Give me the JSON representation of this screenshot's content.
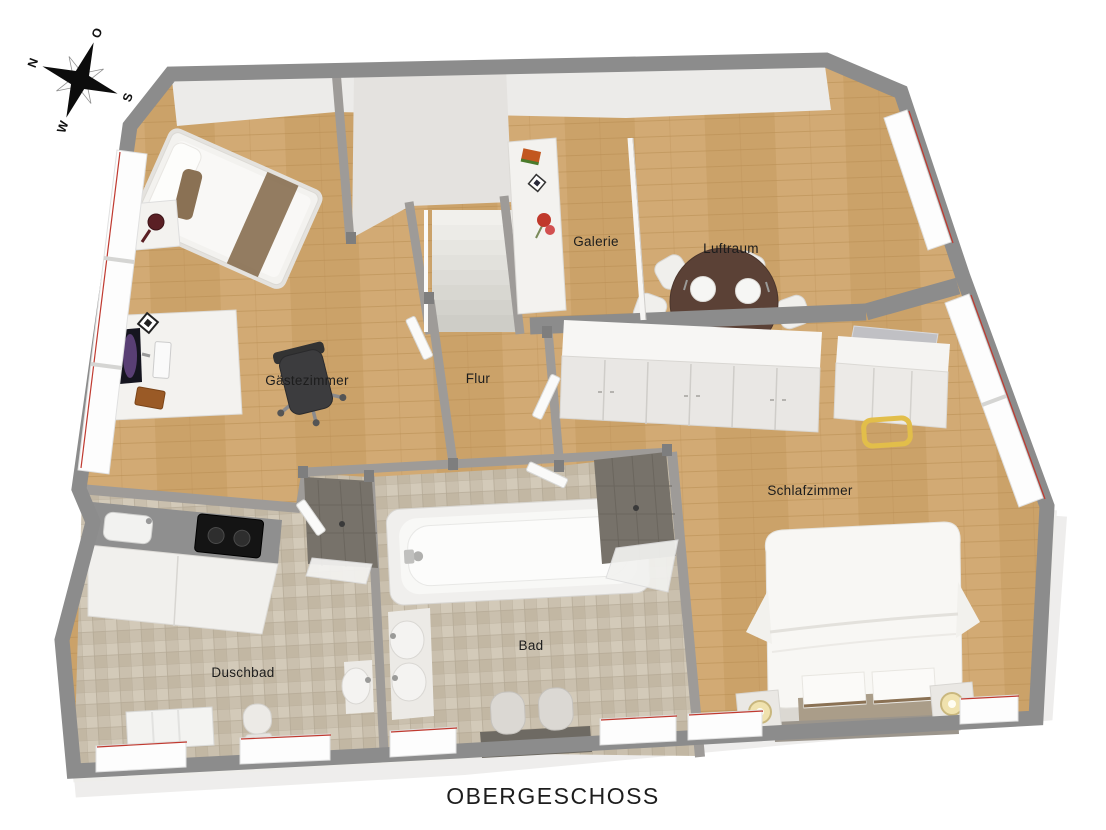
{
  "title": "OBERGESCHOSS",
  "compass": {
    "north": "N",
    "east": "O",
    "south": "S",
    "west": "W"
  },
  "rooms": {
    "gaestezimmer": {
      "label": "Gästezimmer"
    },
    "flur": {
      "label": "Flur"
    },
    "galerie": {
      "label": "Galerie"
    },
    "luftraum": {
      "label": "Luftraum"
    },
    "schlafzimmer": {
      "label": "Schlafzimmer"
    },
    "duschbad": {
      "label": "Duschbad"
    },
    "bad": {
      "label": "Bad"
    }
  },
  "colors": {
    "background": "#ffffff",
    "wall-outer": "#8c8c8c",
    "wall-inner": "#9e9b98",
    "wall-mass": "#e4e2df",
    "wood-floor": "#d2aa74",
    "wood-floor2": "#cba269",
    "wood-line": "#b78e54",
    "tile-a": "#cac0ae",
    "tile-b": "#d3cab9",
    "tile-c": "#c2b7a3",
    "tile-line": "#b0a591",
    "white-furniture": "#f3f2ef",
    "accent-brown": "#8a7154",
    "table-brown": "#5b4136",
    "window-red": "#c03a30",
    "stool-yellow": "#e2be4a",
    "lamp-glow": "#f0e2ae",
    "shower-dark": "#77726a",
    "text": "#1d1d1d"
  }
}
